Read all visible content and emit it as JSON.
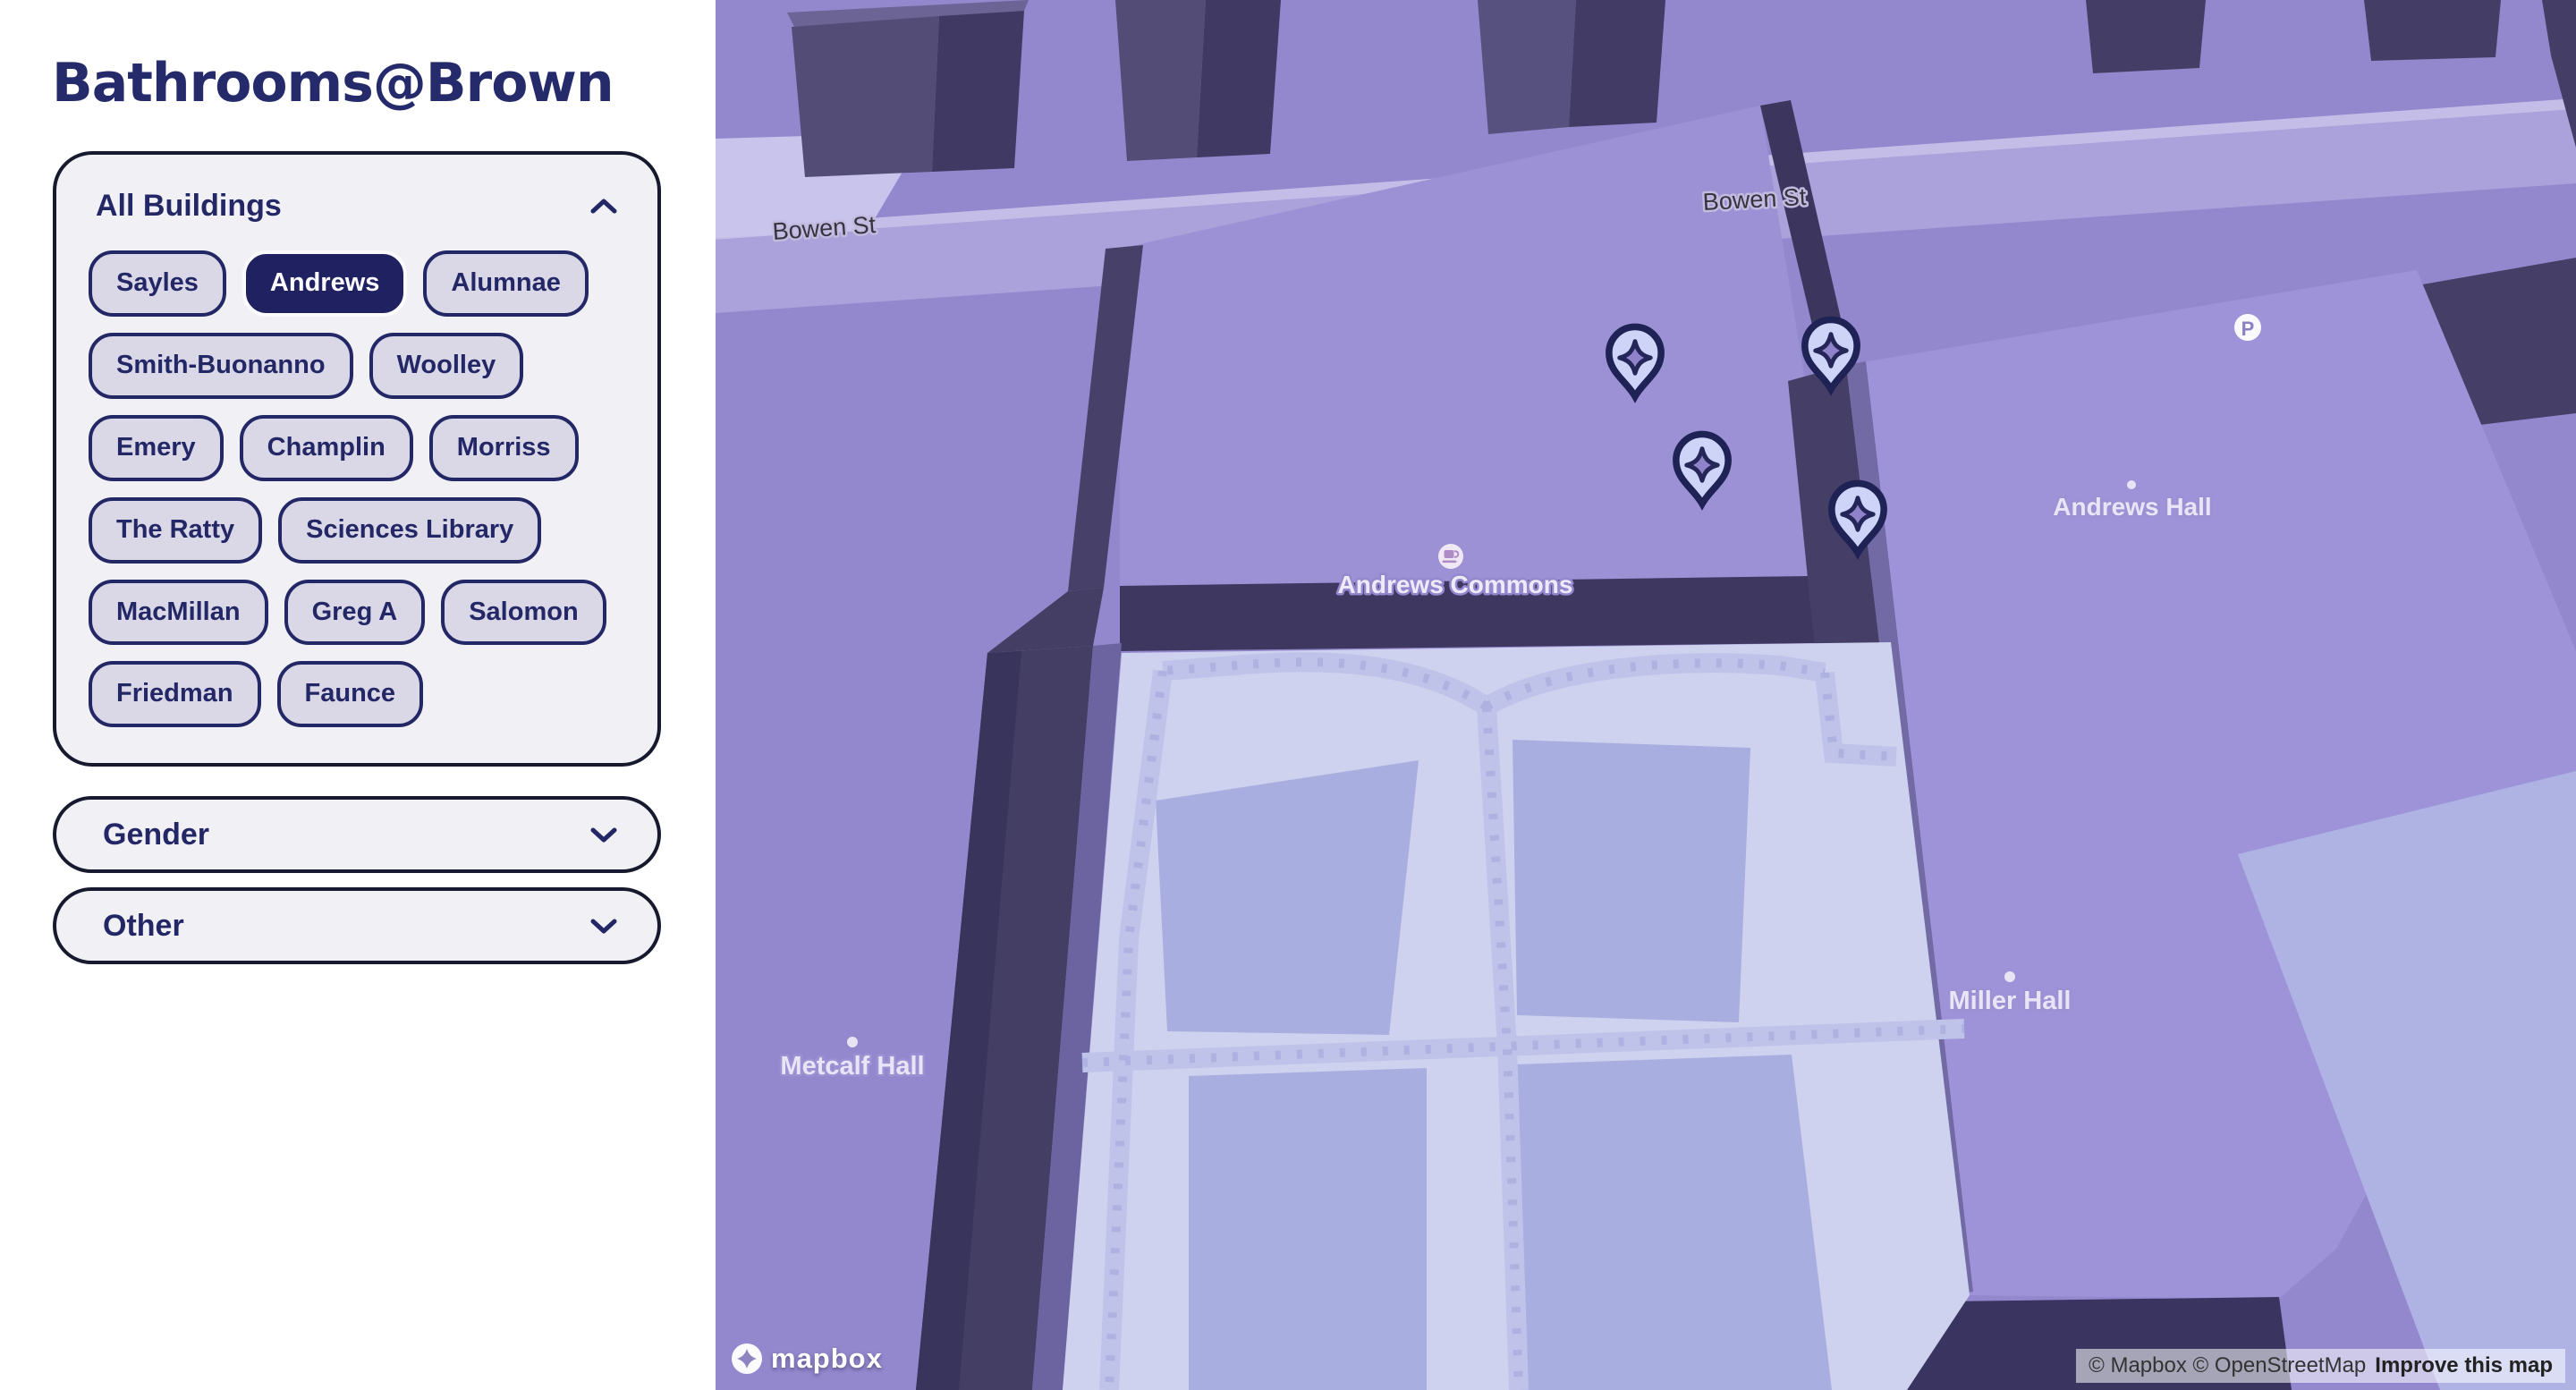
{
  "app": {
    "title": "Bathrooms@Brown"
  },
  "filters": {
    "buildings": {
      "header": "All Buildings",
      "header_icon": "chevron-up",
      "selected": "Andrews",
      "options": [
        "Sayles",
        "Andrews",
        "Alumnae",
        "Smith-Buonanno",
        "Woolley",
        "Emery",
        "Champlin",
        "Morriss",
        "The Ratty",
        "Sciences Library",
        "MacMillan",
        "Greg A",
        "Salomon",
        "Friedman",
        "Faunce"
      ]
    },
    "accordions": [
      {
        "label": "Gender",
        "icon": "chevron-down"
      },
      {
        "label": "Other",
        "icon": "chevron-down"
      }
    ]
  },
  "map": {
    "street_label": "Bowen St",
    "labels": {
      "andrews_commons": "Andrews Commons",
      "andrews_hall": "Andrews Hall",
      "miller_hall": "Miller Hall",
      "metcalf_hall": "Metcalf Hall"
    },
    "parking_label": "P",
    "poi_icons": [
      "coffee-cup",
      "parking"
    ],
    "markers": {
      "type": "bathroom-sparkle-pin",
      "count": 4
    },
    "logo_text": "mapbox",
    "attribution": {
      "copyright": "© Mapbox © OpenStreetMap",
      "improve_link": "Improve this map"
    }
  },
  "colors": {
    "navy": "#232766",
    "selected_bg": "#1f2161",
    "chip_bg": "#dad8e7",
    "panel_bg": "#f1f1f5",
    "map_ground": "#9388cd",
    "map_roof": "#9c91d5",
    "map_wall_dark": "#453f68",
    "map_plaza": "#ced2ee",
    "map_grass": "#a9aee0",
    "pin_fill": "#ced4f8",
    "pin_stroke": "#1f2254"
  }
}
